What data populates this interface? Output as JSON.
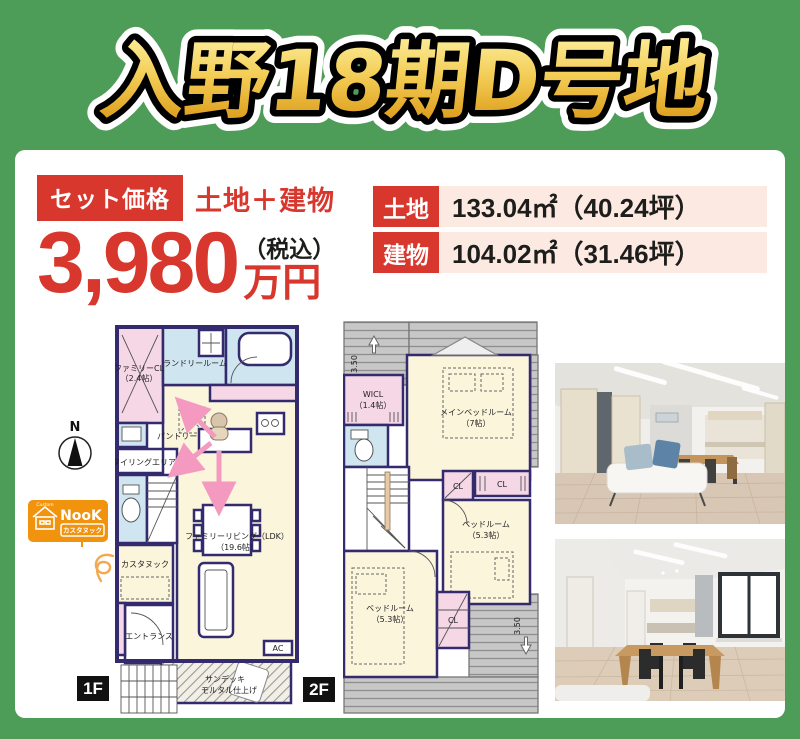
{
  "page": {
    "title": "入野18期D号地",
    "bg_color": "#4d9c57",
    "accent_red": "#d7372d",
    "gold_top": "#fdf0a0",
    "gold_bottom": "#d8920f"
  },
  "price": {
    "badge": "セット価格",
    "subtitle": "土地＋建物",
    "amount": "3,980",
    "tax_note": "（税込）",
    "unit": "万円"
  },
  "area_info": {
    "rows": [
      {
        "label": "土地",
        "value": "133.04㎡（40.24坪）"
      },
      {
        "label": "建物",
        "value": "104.02㎡（31.46坪）"
      }
    ]
  },
  "compass": {
    "label": "N"
  },
  "logo": {
    "custom": "Custom",
    "name": "NooK",
    "subtitle": "カスタヌック"
  },
  "floor1": {
    "tag": "1F",
    "labels": {
      "family_cl": "ファミリーCL",
      "family_cl_size": "（2.4帖）",
      "laundry": "ランドリールーム",
      "pantry": "パントリー",
      "styling": "スタイリングエリア",
      "living": "ファミリーリビング（LDK）",
      "living_size": "（19.6帖）",
      "nook": "カスタヌック",
      "entrance": "エントランス",
      "sundeck": "サンデッキ",
      "sundeck_note": "モルタル仕上げ",
      "ac": "AC"
    }
  },
  "floor2": {
    "tag": "2F",
    "labels": {
      "wicl": "WICL",
      "wicl_size": "（1.4帖）",
      "main_bedroom": "メインベッドルーム",
      "main_bedroom_size": "（7帖）",
      "bedroom": "ベッドルーム",
      "bedroom_size": "（5.3帖）",
      "cl": "CL",
      "dim": "3.50"
    }
  }
}
